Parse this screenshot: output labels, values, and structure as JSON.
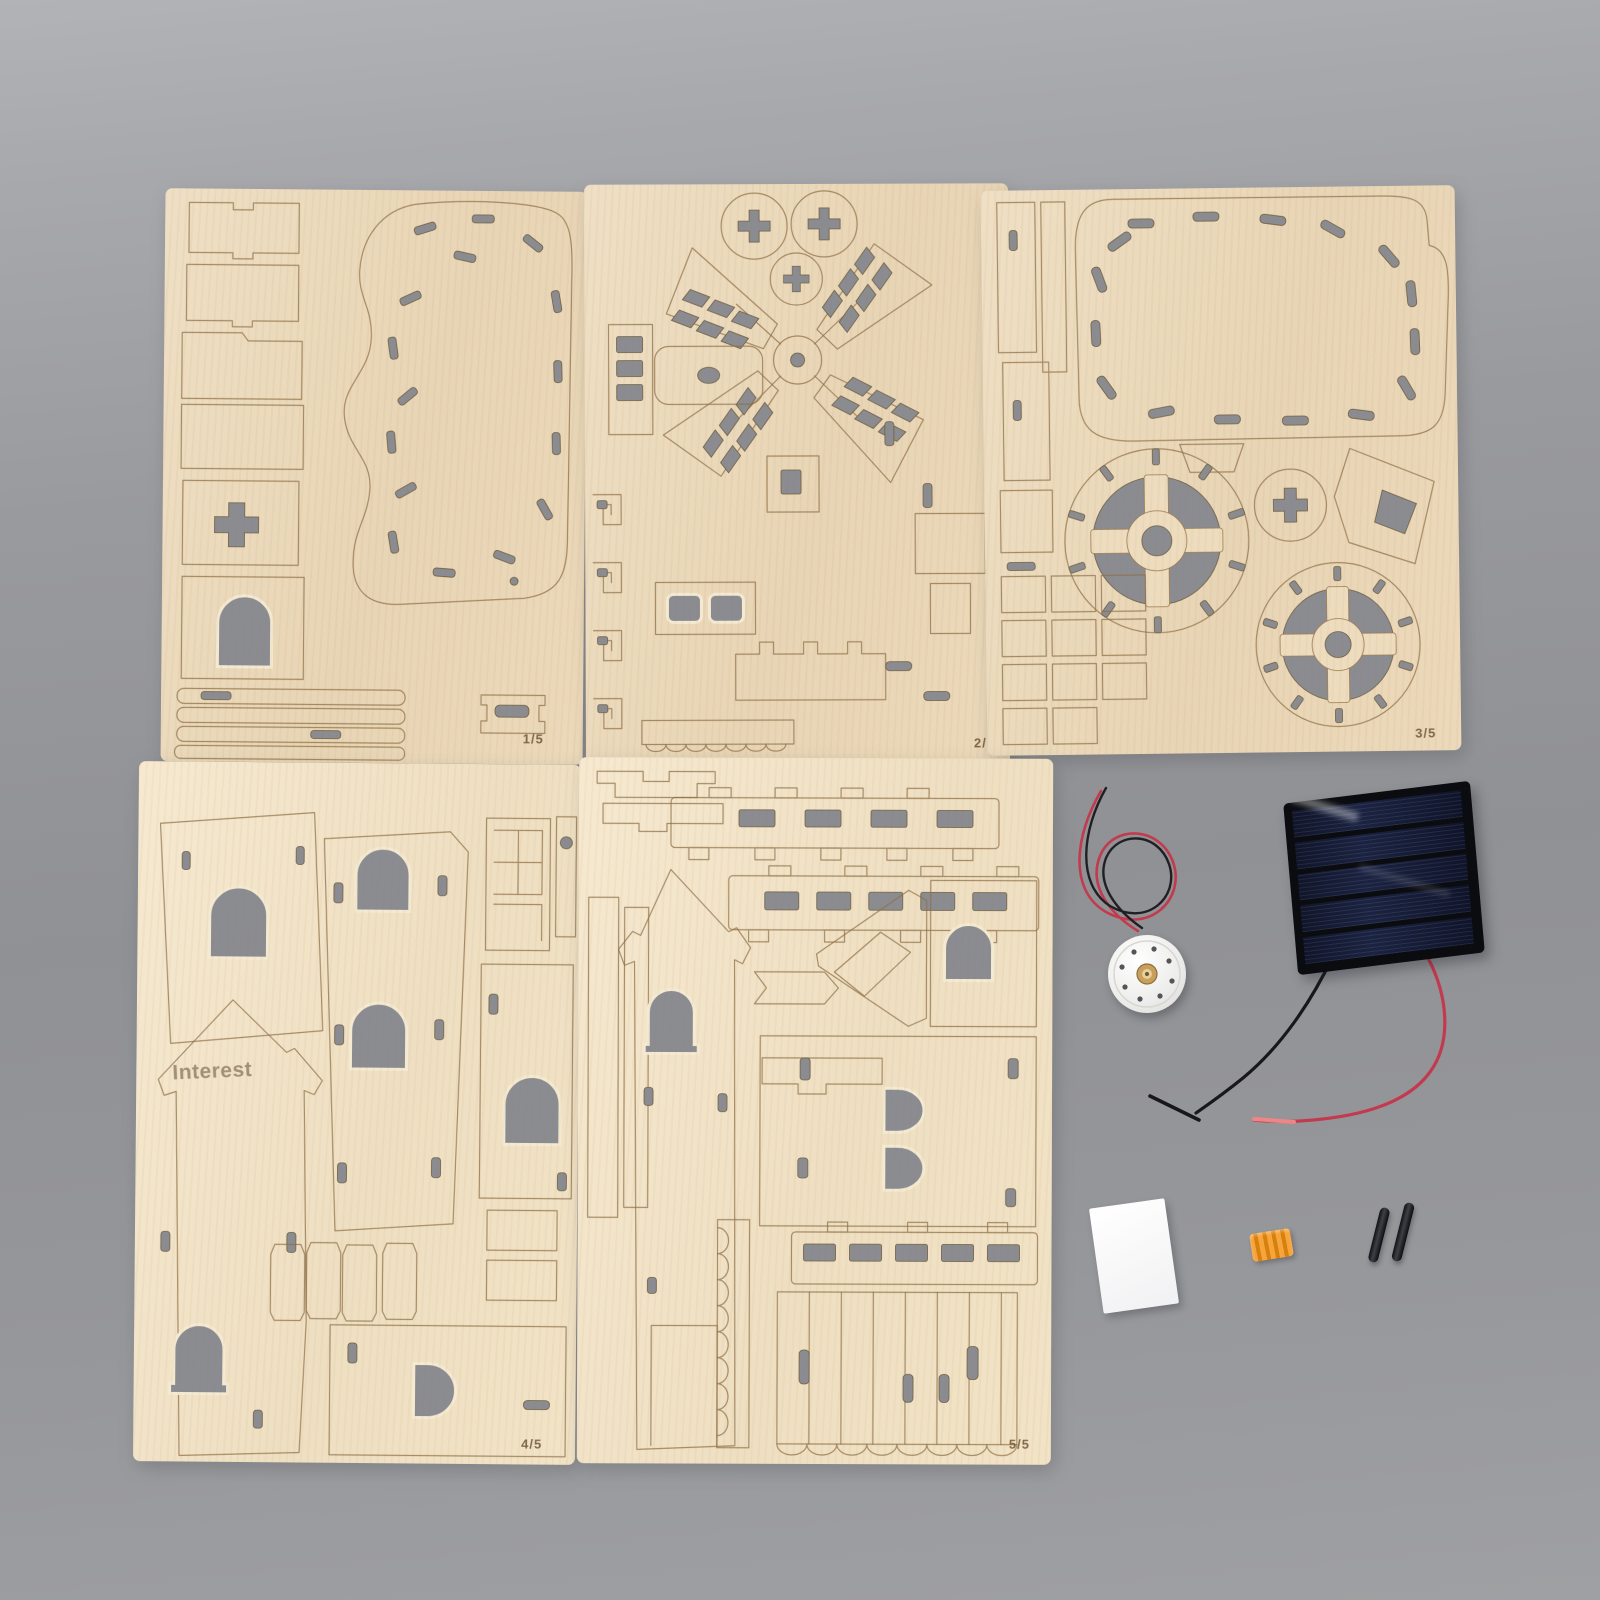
{
  "scene": {
    "colors": {
      "background": "#95969a",
      "background_top": "#b2b3b7",
      "plywood": "#ecdabd",
      "plywood_light": "#f2e5cb",
      "cut_line": "#8d6f46",
      "cutout": "#8b8c91",
      "solar_cell": "#1b2342",
      "solar_frame": "#0b0c10",
      "wire_red": "#c23a4e",
      "wire_red_tip": "#ef8585",
      "wire_black": "#1c1c20",
      "motor_body": "#f3f2ef",
      "motor_shaft": "#c99f5c",
      "coupling_orange": "#f7a43a",
      "card_white": "#fafafa",
      "pin_black": "#222226"
    }
  },
  "sheets": [
    {
      "label": "1/5"
    },
    {
      "label": "2/5"
    },
    {
      "label": "3/5"
    },
    {
      "label": "4/5",
      "engraving": "Interest"
    },
    {
      "label": "5/5"
    }
  ],
  "components": {
    "motor": "dc-motor",
    "solar_panel": "solar-panel",
    "wire_red": "red-wire",
    "wire_black": "black-wire",
    "pad": "white-pad",
    "coupling": "orange-coupling",
    "pins": "axle-pins"
  }
}
